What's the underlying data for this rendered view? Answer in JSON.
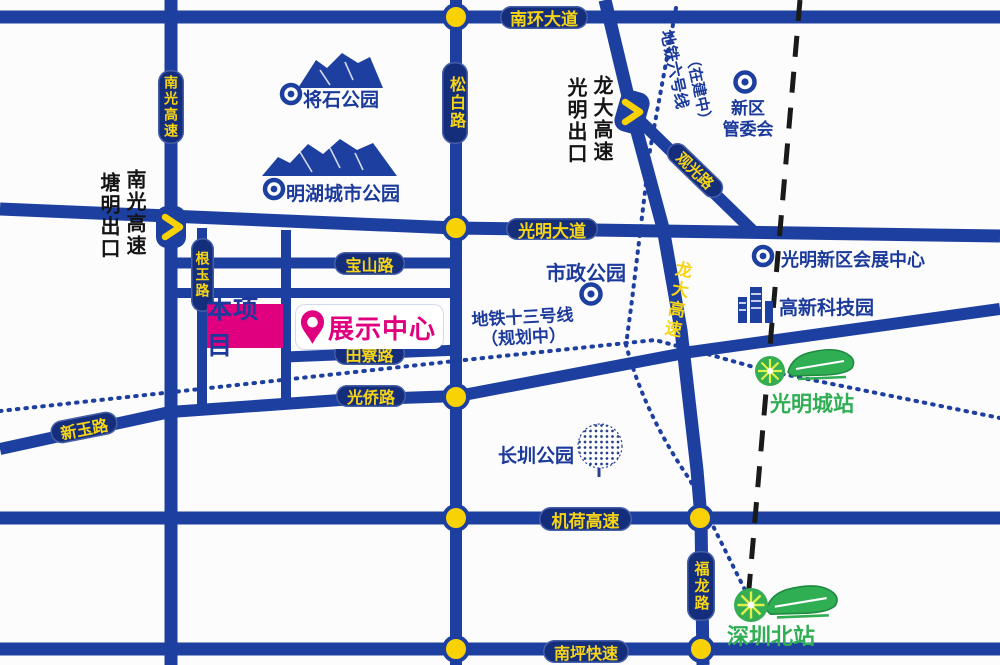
{
  "roads": {
    "nanhuan": "南环大道",
    "songbai": "松白路",
    "nanguang": "南光高速",
    "guangming": "光明大道",
    "baoshan": "宝山路",
    "genyu": "根玉路",
    "tianliao": "田寮路",
    "guangqiao": "光侨路",
    "xinyu": "新玉路",
    "jihe": "机荷高速",
    "nanping": "南坪快速",
    "fulong": "福龙路",
    "longda": "龙大高速",
    "guanguang": "观光路"
  },
  "exits": {
    "tangming_exit": "塘明出口",
    "nanguang_expwy": "南光高速",
    "guangming_exit": "光明出口",
    "longda_expwy": "龙大高速"
  },
  "metro": {
    "line6_name": "地铁六号线",
    "line6_status": "（在建中）",
    "line13_name": "地铁十三号线",
    "line13_status": "（规划中）"
  },
  "parks": {
    "jiangshi": "将石公园",
    "minghu": "明湖城市公园",
    "shizheng": "市政公园",
    "changzhen": "长圳公园"
  },
  "landmarks": {
    "xinqu_line1": "新区",
    "xinqu_line2": "管委会",
    "convention": "光明新区会展中心",
    "hightech": "高新科技园"
  },
  "stations": {
    "guangmingcheng": "光明城站",
    "shenzhenbei": "深圳北站"
  },
  "project": {
    "site": "本项目",
    "showroom": "展示中心"
  },
  "icons": {
    "park_marker": "bullseye-icon",
    "government_marker": "bullseye-icon",
    "mountain": "mountain-icon",
    "tree": "tree-icon",
    "buildings": "buildings-icon",
    "train": "train-icon",
    "station_burst": "starburst-icon",
    "location_pin": "pin-icon",
    "exit_chevron": "chevron-right-icon",
    "junction_dot": "junction-dot-icon"
  },
  "colors": {
    "road_blue": "#1d3f9f",
    "pill_navy": "#142e7c",
    "label_yellow": "#f7d414",
    "dot_yellow": "#f9d205",
    "magenta": "#e0007f",
    "green": "#2fae54",
    "ray_yellow": "#dff24b",
    "text_navy": "#1b3a9b",
    "boundary_black": "#1a1a1a"
  }
}
